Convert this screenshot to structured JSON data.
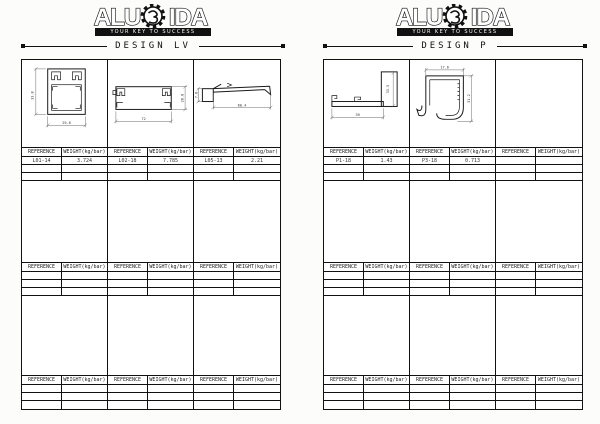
{
  "document": {
    "brand": {
      "name_left": "ALU",
      "name_right": "IDA",
      "tagline": "YOUR KEY TO SUCCESS"
    },
    "labels": {
      "reference": "REFERENCE",
      "weight": "WEIGHT(kg/bar)"
    },
    "panels": [
      {
        "title": "DESIGN LV",
        "entries": [
          {
            "reference": "L01-14",
            "weight": "3.724"
          },
          {
            "reference": "L02-18",
            "weight": "7.785"
          },
          {
            "reference": "L05-13",
            "weight": "2.21"
          }
        ],
        "drawings": [
          {
            "dim_left": "33.8",
            "dim_bottom": "29.8"
          },
          {
            "dim_right": "28.8",
            "dim_bottom": "72"
          },
          {
            "dim_left": "7.8",
            "dim_bottom": "60.4"
          }
        ]
      },
      {
        "title": "DESIGN P",
        "entries": [
          {
            "reference": "P1-18",
            "weight": "1.43"
          },
          {
            "reference": "P3-18",
            "weight": "0.713"
          },
          {
            "reference": "",
            "weight": ""
          }
        ],
        "drawings": [
          {
            "dim_right": "33.5",
            "dim_bottom": "39"
          },
          {
            "dim_top": "17.6",
            "dim_right": "31.2"
          }
        ]
      }
    ]
  }
}
